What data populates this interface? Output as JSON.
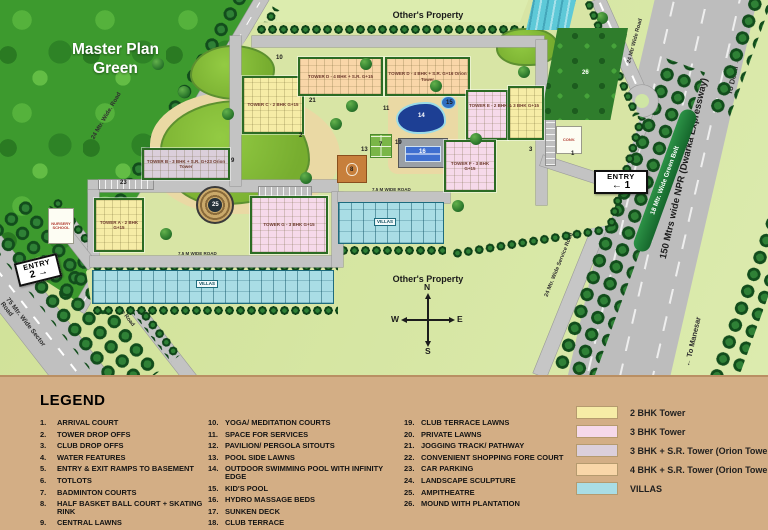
{
  "map": {
    "title": "Master Plan Green",
    "others_property_top": "Other's Property",
    "others_property_bottom": "Other's Property",
    "compass": {
      "n": "N",
      "e": "E",
      "s": "S",
      "w": "W"
    },
    "entry1": {
      "line1": "ENTRY",
      "line2": "← 1"
    },
    "entry2": {
      "line1": "ENTRY",
      "line2": "2 →"
    },
    "roads": {
      "road24_topleft": "24 Mtr. Wide. Road",
      "road24_topright": "24 Mtr Wide Road",
      "npr": "150 Mtrs wide NPR (Dwarka Expressway)",
      "green_belt": "18 Mtr. Wide Green Belt",
      "to_delhi": "To Delhi →",
      "to_manesar": "← To Manesar",
      "service_road_right": "24 Mtr. Wide Service Road",
      "service_road_left": "24 Mtr. Wide Service Road",
      "sector_road": "75 Mtr. Wide Sector Road",
      "internal_road_1": "7.5 M WIDE ROAD",
      "internal_road_2": "7.5 M WIDE ROAD"
    },
    "towers": {
      "a": "TOWER A - 2 BHK G+15",
      "b": "TOWER B - 3 BHK + S.R. G+23 Orion Tower",
      "c": "TOWER C - 2 BHK G+15",
      "d1": "TOWER D - 4 BHK + S.R. G+15",
      "d2": "TOWER D - 4 BHK + S.R. G+16 Orion Tower",
      "e": "TOWER E - 2 BHK & 3 BHK G+15",
      "f": "TOWER F - 3 BHK G+15",
      "g": "TOWER G - 3 BHK G+15"
    },
    "villas_label": "VILLAS",
    "conv_shop": "CONV.",
    "nursery": "NURSERY SCHOOL",
    "markers": [
      "1",
      "2",
      "3",
      "7",
      "8",
      "9",
      "10",
      "11",
      "13",
      "14",
      "15",
      "16",
      "19",
      "21",
      "23",
      "25",
      "26"
    ]
  },
  "legend": {
    "title": "LEGEND",
    "items": [
      {
        "num": "1.",
        "label": "ARRIVAL COURT"
      },
      {
        "num": "2.",
        "label": "TOWER DROP OFFS"
      },
      {
        "num": "3.",
        "label": "CLUB DROP OFFS"
      },
      {
        "num": "4.",
        "label": "WATER FEATURES"
      },
      {
        "num": "5.",
        "label": "ENTRY & EXIT RAMPS TO BASEMENT"
      },
      {
        "num": "6.",
        "label": "TOTLOTS"
      },
      {
        "num": "7.",
        "label": "BADMINTON COURTS"
      },
      {
        "num": "8.",
        "label": "HALF BASKET BALL COURT + SKATING RINK"
      },
      {
        "num": "9.",
        "label": "CENTRAL LAWNS"
      },
      {
        "num": "10.",
        "label": "YOGA/ MEDITATION COURTS"
      },
      {
        "num": "11.",
        "label": "SPACE FOR SERVICES"
      },
      {
        "num": "12.",
        "label": "PAVILION/ PERGOLA SITOUTS"
      },
      {
        "num": "13.",
        "label": "POOL SIDE LAWNS"
      },
      {
        "num": "14.",
        "label": "OUTDOOR SWIMMING POOL WITH INFINITY EDGE"
      },
      {
        "num": "15.",
        "label": "KID'S POOL"
      },
      {
        "num": "16.",
        "label": "HYDRO MASSAGE BEDS"
      },
      {
        "num": "17.",
        "label": "SUNKEN DECK"
      },
      {
        "num": "18.",
        "label": "CLUB TERRACE"
      },
      {
        "num": "19.",
        "label": "CLUB TERRACE LAWNS"
      },
      {
        "num": "20.",
        "label": "PRIVATE LAWNS"
      },
      {
        "num": "21.",
        "label": "JOGGING TRACK/ PATHWAY"
      },
      {
        "num": "22.",
        "label": "CONVENIENT SHOPPING FORE COURT"
      },
      {
        "num": "23.",
        "label": "CAR PARKING"
      },
      {
        "num": "24.",
        "label": "LANDSCAPE SCULPTURE"
      },
      {
        "num": "25.",
        "label": "AMPITHEATRE"
      },
      {
        "num": "26.",
        "label": "MOUND WITH PLANTATION"
      }
    ],
    "key": [
      {
        "color": "#f6eca6",
        "label": "2 BHK Tower"
      },
      {
        "color": "#f6d9ea",
        "label": "3 BHK Tower"
      },
      {
        "color": "#dbcfdb",
        "label": "3 BHK + S.R. Tower (Orion Tower)"
      },
      {
        "color": "#f9d6a8",
        "label": "4 BHK + S.R. Tower (Orion Tower)"
      },
      {
        "color": "#a9dde5",
        "label": "VILLAS"
      }
    ]
  }
}
